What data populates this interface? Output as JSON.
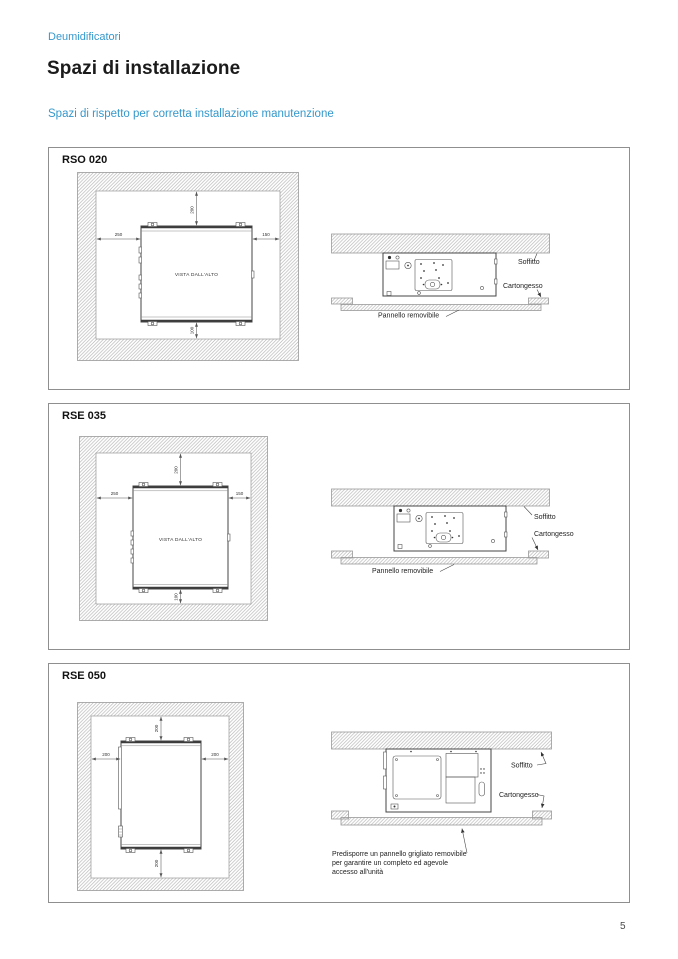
{
  "page": {
    "breadcrumb": "Deumidificatori",
    "title": "Spazi di installazione",
    "subtitle": "Spazi di rispetto per corretta installazione manutenzione",
    "page_number": "5"
  },
  "colors": {
    "accent_blue": "#3598cc"
  },
  "panels": [
    {
      "model": "RSO 020",
      "top_view": {
        "center_label": "VISTA DALL'ALTO",
        "dim_top": "200",
        "dim_left": "250",
        "dim_right": "150",
        "dim_bottom": "100"
      },
      "side_view": {
        "label_soffitto": "Soffitto",
        "label_cartongesso": "Cartongesso",
        "label_pannello": "Pannello removibile"
      }
    },
    {
      "model": "RSE 035",
      "top_view": {
        "center_label": "VISTA DALL'ALTO",
        "dim_top": "200",
        "dim_left": "250",
        "dim_right": "150",
        "dim_bottom": "100"
      },
      "side_view": {
        "label_soffitto": "Soffitto",
        "label_cartongesso": "Cartongesso",
        "label_pannello": "Pannello removibile"
      }
    },
    {
      "model": "RSE 050",
      "top_view": {
        "dim_top": "200",
        "dim_left": "200",
        "dim_right": "200",
        "dim_bottom": "200"
      },
      "side_view": {
        "label_soffitto": "Soffitto",
        "label_cartongesso": "Cartongesso",
        "caption": "Predisporre un pannello grigliato removibile per garantire un completo ed agevole accesso all'unità"
      }
    }
  ]
}
